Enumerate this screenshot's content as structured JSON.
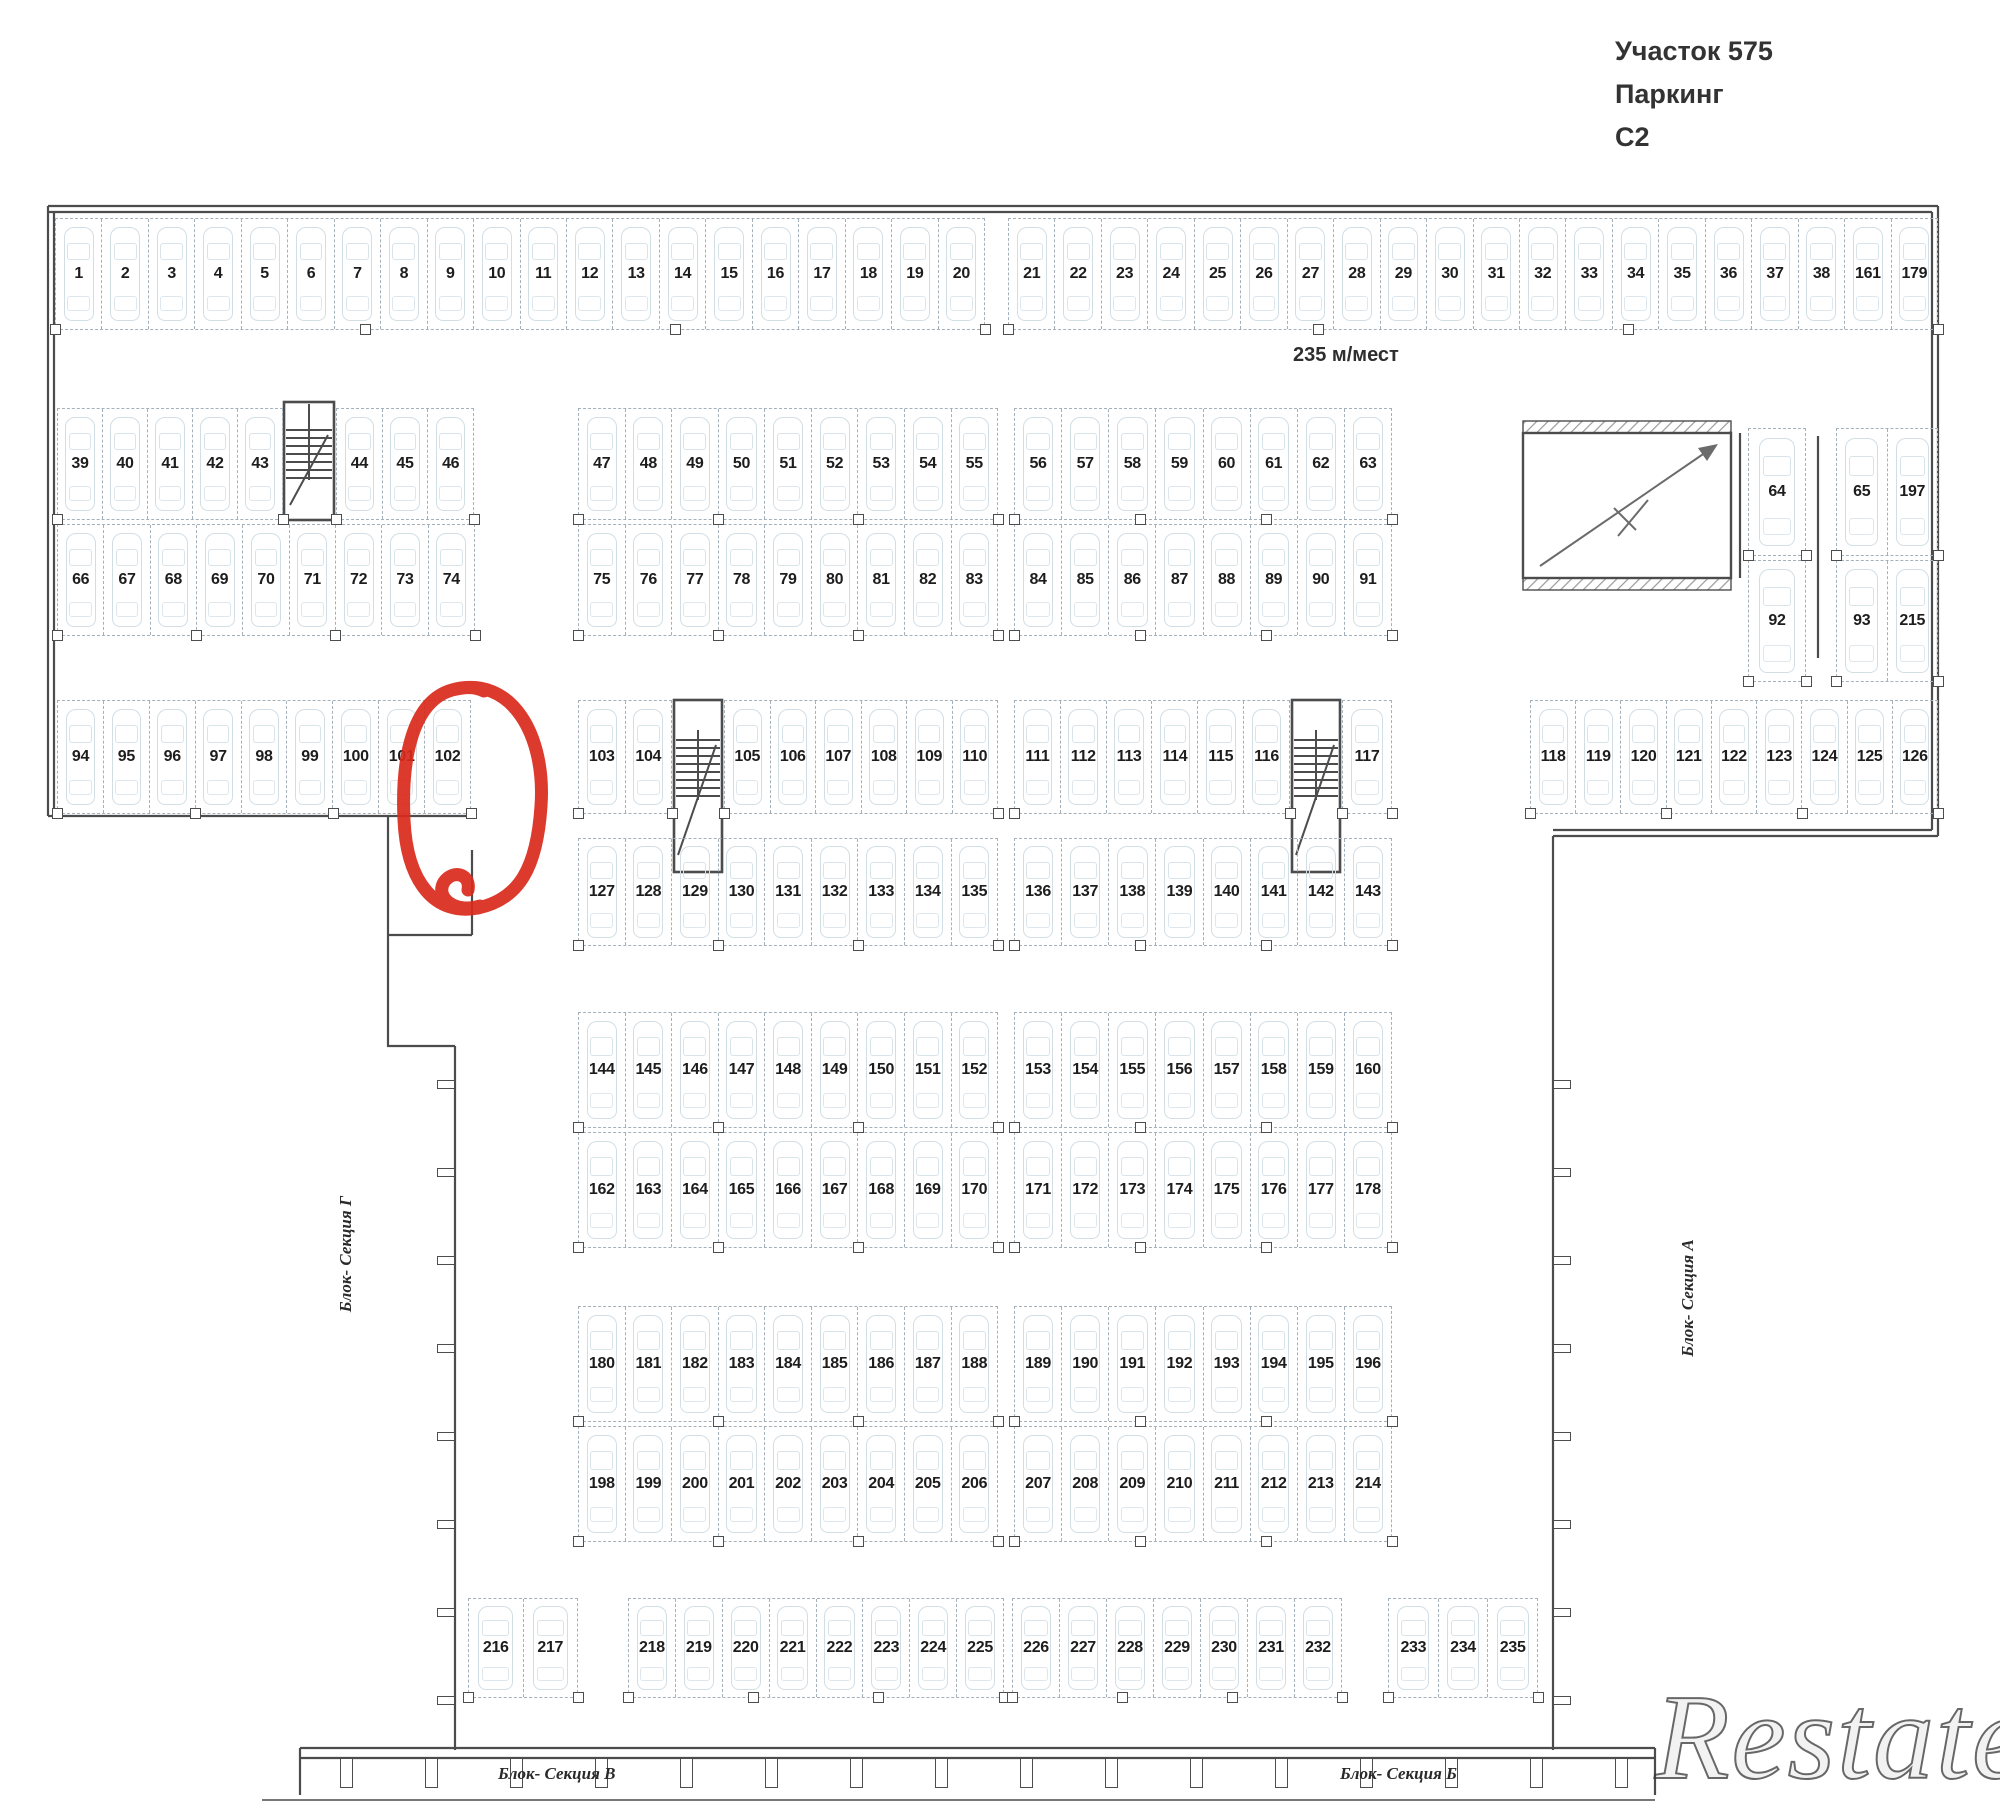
{
  "header": {
    "line1": "Участок 575",
    "line2": "Паркинг",
    "line3": "С2"
  },
  "capacity_note": "235 м/мест",
  "highlight": {
    "spot": "102",
    "color": "#da291c",
    "shape": "hand-drawn-circle"
  },
  "watermark": "Restate",
  "section_labels": {
    "left": "Блок- Секция Г",
    "right": "Блок- Секция А",
    "bottom_left": "Блок- Секция В",
    "bottom_right": "Блок- Секция Б"
  },
  "plan": {
    "groups": [
      {
        "id": "r1a",
        "x": 55,
        "y": 218,
        "w": 930,
        "h": 112,
        "spots": [
          1,
          2,
          3,
          4,
          5,
          6,
          7,
          8,
          9,
          10,
          11,
          12,
          13,
          14,
          15,
          16,
          17,
          18,
          19,
          20
        ]
      },
      {
        "id": "r1b",
        "x": 1008,
        "y": 218,
        "w": 930,
        "h": 112,
        "spots": [
          21,
          22,
          23,
          24,
          25,
          26,
          27,
          28,
          29,
          30,
          31,
          32,
          33,
          34,
          35,
          36,
          37,
          38,
          161,
          179
        ]
      },
      {
        "id": "r2a",
        "x": 57,
        "y": 408,
        "w": 226,
        "h": 112,
        "spots": [
          39,
          40,
          41,
          42,
          43
        ]
      },
      {
        "id": "r2b",
        "x": 336,
        "y": 408,
        "w": 138,
        "h": 112,
        "spots": [
          44,
          45,
          46
        ]
      },
      {
        "id": "r2c",
        "x": 578,
        "y": 408,
        "w": 420,
        "h": 112,
        "spots": [
          47,
          48,
          49,
          50,
          51,
          52,
          53,
          54,
          55
        ]
      },
      {
        "id": "r2d",
        "x": 1014,
        "y": 408,
        "w": 378,
        "h": 112,
        "spots": [
          56,
          57,
          58,
          59,
          60,
          61,
          62,
          63
        ]
      },
      {
        "id": "r2e",
        "x": 1748,
        "y": 428,
        "w": 58,
        "h": 128,
        "spots": [
          64
        ]
      },
      {
        "id": "r2f",
        "x": 1836,
        "y": 428,
        "w": 102,
        "h": 128,
        "spots": [
          65,
          197
        ]
      },
      {
        "id": "r2g",
        "x": 1748,
        "y": 560,
        "w": 58,
        "h": 122,
        "spots": [
          92
        ]
      },
      {
        "id": "r2h",
        "x": 1836,
        "y": 560,
        "w": 102,
        "h": 122,
        "spots": [
          93,
          215
        ]
      },
      {
        "id": "r3a",
        "x": 57,
        "y": 524,
        "w": 418,
        "h": 112,
        "spots": [
          66,
          67,
          68,
          69,
          70,
          71,
          72,
          73,
          74
        ]
      },
      {
        "id": "r3b",
        "x": 578,
        "y": 524,
        "w": 420,
        "h": 112,
        "spots": [
          75,
          76,
          77,
          78,
          79,
          80,
          81,
          82,
          83
        ]
      },
      {
        "id": "r3c",
        "x": 1014,
        "y": 524,
        "w": 378,
        "h": 112,
        "spots": [
          84,
          85,
          86,
          87,
          88,
          89,
          90,
          91
        ]
      },
      {
        "id": "r4a",
        "x": 57,
        "y": 700,
        "w": 414,
        "h": 114,
        "spots": [
          94,
          95,
          96,
          97,
          98,
          99,
          100,
          101,
          102
        ]
      },
      {
        "id": "r4b",
        "x": 578,
        "y": 700,
        "w": 94,
        "h": 114,
        "spots": [
          103,
          104
        ]
      },
      {
        "id": "r4c",
        "x": 724,
        "y": 700,
        "w": 274,
        "h": 114,
        "spots": [
          105,
          106,
          107,
          108,
          109,
          110
        ]
      },
      {
        "id": "r4d",
        "x": 1014,
        "y": 700,
        "w": 276,
        "h": 114,
        "spots": [
          111,
          112,
          113,
          114,
          115,
          116
        ]
      },
      {
        "id": "r4e",
        "x": 1342,
        "y": 700,
        "w": 50,
        "h": 114,
        "spots": [
          117
        ]
      },
      {
        "id": "r4f",
        "x": 1530,
        "y": 700,
        "w": 408,
        "h": 114,
        "spots": [
          118,
          119,
          120,
          121,
          122,
          123,
          124,
          125,
          126
        ]
      },
      {
        "id": "r5a",
        "x": 578,
        "y": 838,
        "w": 420,
        "h": 108,
        "spots": [
          127,
          128,
          129,
          130,
          131,
          132,
          133,
          134,
          135
        ]
      },
      {
        "id": "r5b",
        "x": 1014,
        "y": 838,
        "w": 378,
        "h": 108,
        "spots": [
          136,
          137,
          138,
          139,
          140,
          141,
          142,
          143
        ]
      },
      {
        "id": "r6a",
        "x": 578,
        "y": 1012,
        "w": 420,
        "h": 116,
        "spots": [
          144,
          145,
          146,
          147,
          148,
          149,
          150,
          151,
          152
        ]
      },
      {
        "id": "r6b",
        "x": 1014,
        "y": 1012,
        "w": 378,
        "h": 116,
        "spots": [
          153,
          154,
          155,
          156,
          157,
          158,
          159,
          160
        ]
      },
      {
        "id": "r7a",
        "x": 578,
        "y": 1132,
        "w": 420,
        "h": 116,
        "spots": [
          162,
          163,
          164,
          165,
          166,
          167,
          168,
          169,
          170
        ]
      },
      {
        "id": "r7b",
        "x": 1014,
        "y": 1132,
        "w": 378,
        "h": 116,
        "spots": [
          171,
          172,
          173,
          174,
          175,
          176,
          177,
          178
        ]
      },
      {
        "id": "r8a",
        "x": 578,
        "y": 1306,
        "w": 420,
        "h": 116,
        "spots": [
          180,
          181,
          182,
          183,
          184,
          185,
          186,
          187,
          188
        ]
      },
      {
        "id": "r8b",
        "x": 1014,
        "y": 1306,
        "w": 378,
        "h": 116,
        "spots": [
          189,
          190,
          191,
          192,
          193,
          194,
          195,
          196
        ]
      },
      {
        "id": "r9a",
        "x": 578,
        "y": 1426,
        "w": 420,
        "h": 116,
        "spots": [
          198,
          199,
          200,
          201,
          202,
          203,
          204,
          205,
          206
        ]
      },
      {
        "id": "r9b",
        "x": 1014,
        "y": 1426,
        "w": 378,
        "h": 116,
        "spots": [
          207,
          208,
          209,
          210,
          211,
          212,
          213,
          214
        ]
      },
      {
        "id": "r10a",
        "x": 468,
        "y": 1598,
        "w": 110,
        "h": 100,
        "spots": [
          216,
          217
        ]
      },
      {
        "id": "r10b",
        "x": 628,
        "y": 1598,
        "w": 376,
        "h": 100,
        "spots": [
          218,
          219,
          220,
          221,
          222,
          223,
          224,
          225
        ]
      },
      {
        "id": "r10c",
        "x": 1012,
        "y": 1598,
        "w": 330,
        "h": 100,
        "spots": [
          226,
          227,
          228,
          229,
          230,
          231,
          232
        ]
      },
      {
        "id": "r10d",
        "x": 1388,
        "y": 1598,
        "w": 150,
        "h": 100,
        "spots": [
          233,
          234,
          235
        ]
      }
    ],
    "stairwells": [
      {
        "x": 284,
        "y": 402,
        "w": 50,
        "h": 118
      },
      {
        "x": 674,
        "y": 700,
        "w": 48,
        "h": 172
      },
      {
        "x": 1292,
        "y": 700,
        "w": 48,
        "h": 172
      }
    ],
    "ramp": {
      "x": 1523,
      "y": 433,
      "w": 208,
      "h": 145
    }
  }
}
